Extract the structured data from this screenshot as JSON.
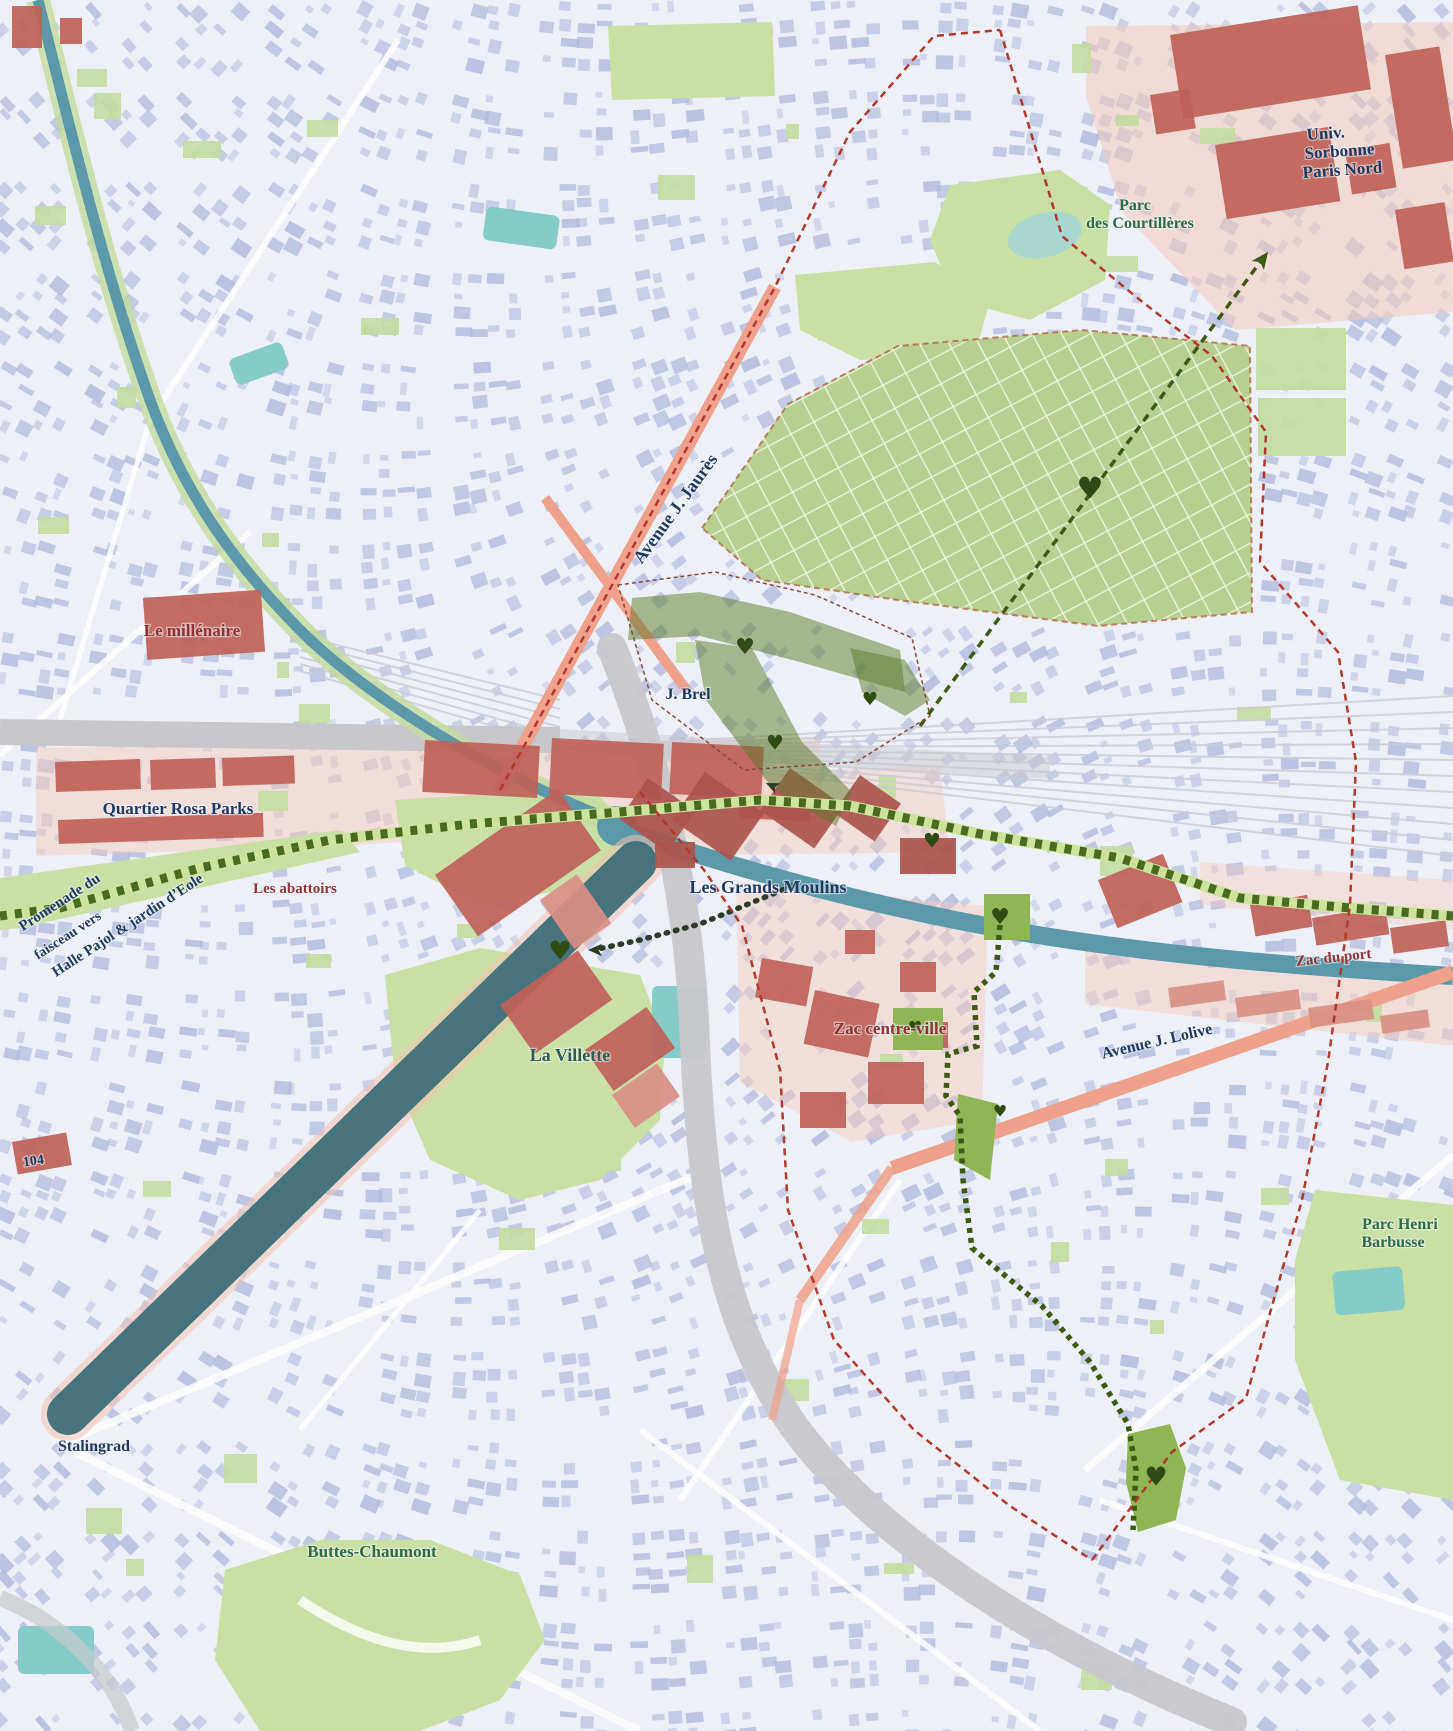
{
  "map": {
    "palette": {
      "background": "#eef0f7",
      "building": "#b2bbdc",
      "park": "#c9dfa3",
      "park_small": "#c3db9f",
      "fort_green": "#b7d08f",
      "fort_grid_line": "#eef3e2",
      "water": "#5b99a8",
      "basin": "#47737d",
      "quay_pink": "#f2c4b4",
      "canal_bank_green": "#c3db9f",
      "road_salmon": "#f0a18c",
      "red_building": "#bf6159",
      "red_building_dark": "#ad544e",
      "red_building_light": "#d98f85",
      "pink_zone": "#f3cabb",
      "gray_road": "#c7c7cb",
      "rail_line": "#caccd6",
      "route_overlay": "#5a7a28",
      "route_line": "#3d5a14",
      "promenade_light": "#cde29a",
      "promenade_dark": "#4a6b1f",
      "dotted_dark": "#2f3b2a",
      "boundary_red": "#b03a2e",
      "gare_outline": "#8a4a3a",
      "heart": "#2f4a12",
      "teal_field": "#85ccc9",
      "pond": "#a9d6ce",
      "street_white": "#ffffff",
      "label_navy": "#1e3a5f",
      "label_darkred": "#8e3434",
      "label_park_green": "#2f6b45",
      "label_teal_green": "#2f5d52"
    },
    "labels": [
      {
        "id": "univ-1",
        "text": "Univ.",
        "x": 1307,
        "y": 140,
        "rot": -4,
        "size": 17,
        "color": "navy",
        "anchor": "start"
      },
      {
        "id": "univ-2",
        "text": "Sorbonne",
        "x": 1305,
        "y": 159,
        "rot": -4,
        "size": 17,
        "color": "navy",
        "anchor": "start"
      },
      {
        "id": "univ-3",
        "text": "Paris Nord",
        "x": 1303,
        "y": 178,
        "rot": -4,
        "size": 17,
        "color": "navy",
        "anchor": "start"
      },
      {
        "id": "courtilleres-1",
        "text": "Parc",
        "x": 1135,
        "y": 210,
        "rot": 0,
        "size": 16,
        "color": "park_green",
        "anchor": "middle"
      },
      {
        "id": "courtilleres-2",
        "text": "des Courtillères",
        "x": 1140,
        "y": 228,
        "rot": 0,
        "size": 16,
        "color": "park_green",
        "anchor": "middle"
      },
      {
        "id": "av-jaures",
        "text": "Avenue J. Jaurès",
        "x": 680,
        "y": 512,
        "rot": -54,
        "size": 18,
        "color": "navy",
        "anchor": "middle"
      },
      {
        "id": "millenaire",
        "text": "Le millénaire",
        "x": 192,
        "y": 636,
        "rot": 0,
        "size": 17,
        "color": "darkred",
        "anchor": "middle"
      },
      {
        "id": "j-brel",
        "text": "J. Brel",
        "x": 688,
        "y": 699,
        "rot": 0,
        "size": 16,
        "color": "navy",
        "anchor": "middle"
      },
      {
        "id": "rosa-parks",
        "text": "Quartier Rosa Parks",
        "x": 178,
        "y": 814,
        "rot": 0,
        "size": 17,
        "color": "navy",
        "anchor": "middle"
      },
      {
        "id": "abattoirs",
        "text": "Les abattoirs",
        "x": 295,
        "y": 893,
        "rot": 0,
        "size": 15,
        "color": "darkred",
        "anchor": "middle"
      },
      {
        "id": "grands-moulins",
        "text": "Les Grands Moulins",
        "x": 768,
        "y": 893,
        "rot": 0,
        "size": 18,
        "color": "navy",
        "anchor": "middle"
      },
      {
        "id": "promenade-1",
        "text": "Promenade du",
        "x": 62,
        "y": 906,
        "rot": -33,
        "size": 15,
        "color": "navy",
        "anchor": "middle"
      },
      {
        "id": "promenade-2",
        "text": "faisceau vers",
        "x": 70,
        "y": 939,
        "rot": -33,
        "size": 14,
        "color": "navy",
        "anchor": "middle"
      },
      {
        "id": "promenade-3",
        "text": "Halle Pajol & jardin d’Eole",
        "x": 130,
        "y": 929,
        "rot": -33,
        "size": 15,
        "color": "navy",
        "anchor": "middle"
      },
      {
        "id": "zac-du-port",
        "text": "Zac du port",
        "x": 1334,
        "y": 962,
        "rot": -6,
        "size": 15,
        "color": "darkred",
        "anchor": "middle"
      },
      {
        "id": "zac-centre",
        "text": "Zac centre-ville",
        "x": 890,
        "y": 1034,
        "rot": 0,
        "size": 17,
        "color": "darkred",
        "anchor": "middle"
      },
      {
        "id": "av-lolive",
        "text": "Avenue J. Lolive",
        "x": 1158,
        "y": 1046,
        "rot": -13,
        "size": 16,
        "color": "navy",
        "anchor": "middle"
      },
      {
        "id": "la-villette",
        "text": "La Villette",
        "x": 570,
        "y": 1061,
        "rot": 0,
        "size": 18,
        "color": "teal_green",
        "anchor": "middle"
      },
      {
        "id": "centquatre",
        "text": "104",
        "x": 34,
        "y": 1165,
        "rot": -8,
        "size": 14,
        "color": "navy",
        "anchor": "middle"
      },
      {
        "id": "barbusse-1",
        "text": "Parc Henri",
        "x": 1400,
        "y": 1229,
        "rot": 0,
        "size": 16,
        "color": "park_green",
        "anchor": "middle"
      },
      {
        "id": "barbusse-2",
        "text": "Barbusse",
        "x": 1393,
        "y": 1247,
        "rot": 0,
        "size": 16,
        "color": "park_green",
        "anchor": "middle"
      },
      {
        "id": "stalingrad",
        "text": "Stalingrad",
        "x": 58,
        "y": 1451,
        "rot": 0,
        "size": 16,
        "color": "navy",
        "anchor": "start"
      },
      {
        "id": "buttes-chaumont",
        "text": "Buttes-Chaumont",
        "x": 372,
        "y": 1557,
        "rot": 0,
        "size": 17,
        "color": "park_green",
        "anchor": "middle"
      }
    ],
    "hearts": [
      {
        "x": 1090,
        "y": 490,
        "size": 30
      },
      {
        "x": 745,
        "y": 648,
        "size": 22
      },
      {
        "x": 775,
        "y": 744,
        "size": 20
      },
      {
        "x": 870,
        "y": 700,
        "size": 18
      },
      {
        "x": 932,
        "y": 842,
        "size": 20
      },
      {
        "x": 1000,
        "y": 918,
        "size": 22
      },
      {
        "x": 560,
        "y": 952,
        "size": 26
      },
      {
        "x": 915,
        "y": 1028,
        "size": 16
      },
      {
        "x": 1000,
        "y": 1112,
        "size": 16
      },
      {
        "x": 1156,
        "y": 1478,
        "size": 26
      }
    ],
    "arrows": [
      {
        "x": 1268,
        "y": 252,
        "angle": -53,
        "size": 17,
        "color": "route_line"
      },
      {
        "x": 588,
        "y": 950,
        "angle": 180,
        "size": 14,
        "color": "dotted_dark"
      },
      {
        "x": 766,
        "y": 783,
        "angle": 205,
        "size": 13,
        "color": "dotted_dark"
      }
    ]
  }
}
